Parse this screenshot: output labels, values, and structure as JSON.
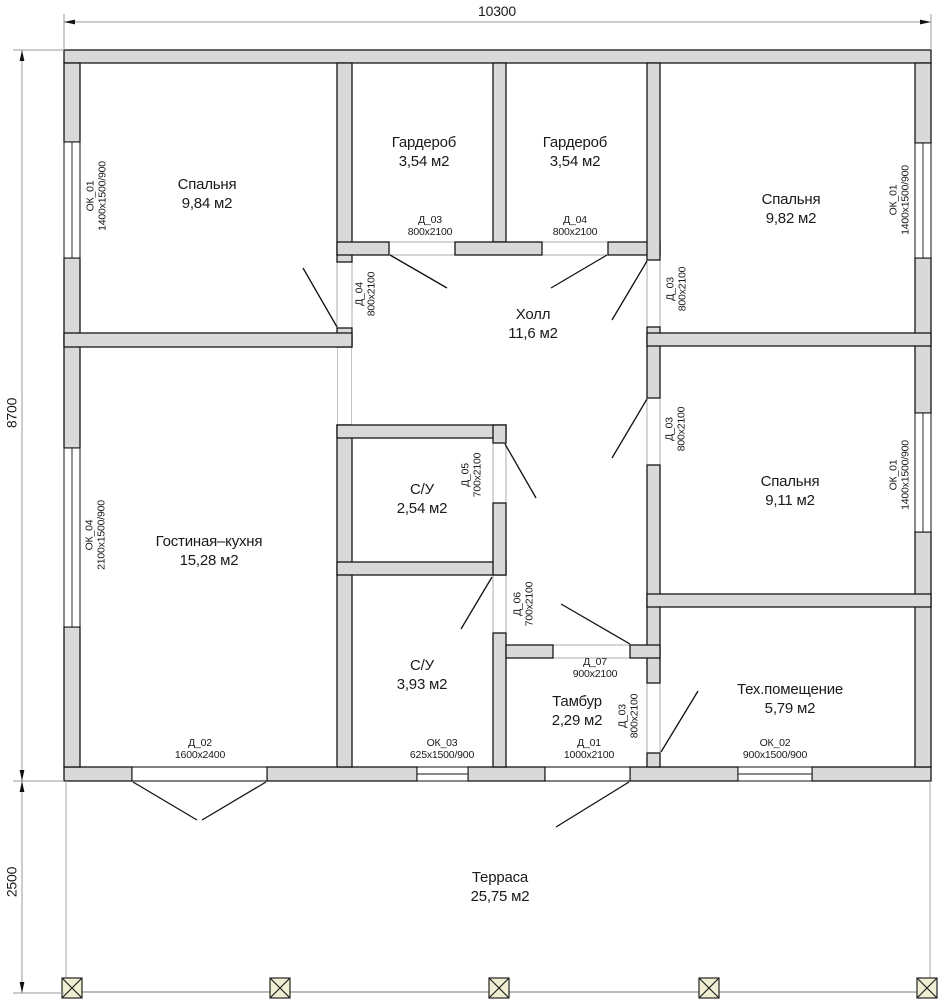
{
  "dims": {
    "top": "10300",
    "left": "8700",
    "terrace": "2500"
  },
  "rooms": [
    {
      "id": "bedroom-1",
      "name": "Спальня",
      "area": "9,84 м2"
    },
    {
      "id": "wardrobe-1",
      "name": "Гардероб",
      "area": "3,54 м2"
    },
    {
      "id": "wardrobe-2",
      "name": "Гардероб",
      "area": "3,54 м2"
    },
    {
      "id": "bedroom-2",
      "name": "Спальня",
      "area": "9,82 м2"
    },
    {
      "id": "hall",
      "name": "Холл",
      "area": "11,6 м2"
    },
    {
      "id": "bedroom-3",
      "name": "Спальня",
      "area": "9,11 м2"
    },
    {
      "id": "living-kitchen",
      "name": "Гостиная–кухня",
      "area": "15,28 м2"
    },
    {
      "id": "bath-1",
      "name": "С/У",
      "area": "2,54 м2"
    },
    {
      "id": "bath-2",
      "name": "С/У",
      "area": "3,93 м2"
    },
    {
      "id": "vestibule",
      "name": "Тамбур",
      "area": "2,29 м2"
    },
    {
      "id": "tech-room",
      "name": "Тех.помещение",
      "area": "5,79 м2"
    },
    {
      "id": "terrace",
      "name": "Терраса",
      "area": "25,75 м2"
    }
  ],
  "h_labels": [
    {
      "name": "Д_03",
      "size": "800x2100"
    },
    {
      "name": "Д_04",
      "size": "800x2100"
    },
    {
      "name": "Д_07",
      "size": "900x2100"
    },
    {
      "name": "Д_02",
      "size": "1600x2400"
    },
    {
      "name": "ОК_03",
      "size": "625x1500/900"
    },
    {
      "name": "Д_01",
      "size": "1000x2100"
    },
    {
      "name": "ОК_02",
      "size": "900x1500/900"
    }
  ],
  "v_labels": [
    {
      "name": "ОК_01",
      "size": "1400x1500/900"
    },
    {
      "name": "ОК_04",
      "size": "2100x1500/900"
    },
    {
      "name": "ОК_01",
      "size": "1400x1500/900"
    },
    {
      "name": "ОК_01",
      "size": "1400x1500/900"
    },
    {
      "name": "Д_04",
      "size": "800x2100"
    },
    {
      "name": "Д_03",
      "size": "800x2100"
    },
    {
      "name": "Д_03",
      "size": "800x2100"
    },
    {
      "name": "Д_05",
      "size": "700x2100"
    },
    {
      "name": "Д_06",
      "size": "700x2100"
    },
    {
      "name": "Д_03",
      "size": "800x2100"
    }
  ],
  "colors": {
    "wall_fill": "#d9d9d9",
    "wall_line": "#161616",
    "dim_line": "#9a9a9a",
    "column_fill": "#f0efd4"
  }
}
